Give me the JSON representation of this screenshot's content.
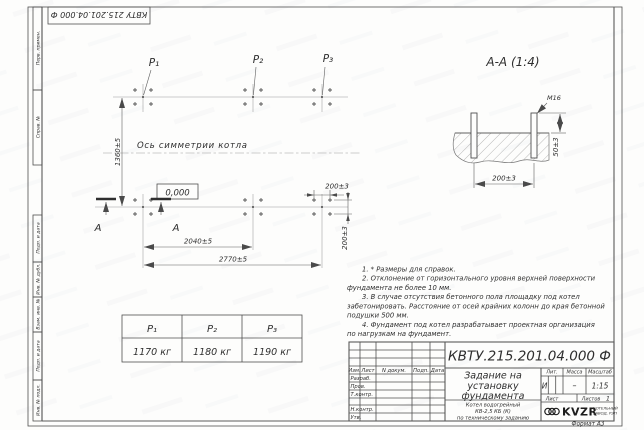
{
  "page": {
    "format_label": "Формат А3"
  },
  "top_stamp": {
    "text": "КВТУ 215.201.04.000  Ф"
  },
  "margin_fields": [
    "Перв. примен.",
    "Справ. №",
    "Подп. и дата",
    "Инв. № дубл.",
    "Взам. инв. №",
    "Подп. и дата",
    "Инв. № подл."
  ],
  "plan": {
    "load_labels": [
      "P₁",
      "P₂",
      "P₃"
    ],
    "axis_label": "Ось симметрии котла",
    "level_mark": "0,000",
    "section_letter": "А",
    "dim_height": "1360±5",
    "dim_width_mid": "2040±5",
    "dim_width_full": "2770±5",
    "dim_bolt_x": "200±3",
    "dim_bolt_y": "200±3"
  },
  "section_view": {
    "title": "А-А (1:4)",
    "thread_label": "М16",
    "dim_protrusion": "50±3",
    "dim_spacing": "200±3"
  },
  "notes": {
    "lines": [
      "1. * Размеры для справок.",
      "2. Отклонение от горизонтального уровня верхней поверхности",
      "фундамента не более 10 мм.",
      "3. В случае отсутствия бетонного пола площадку под котел",
      "забетонировать. Расстояние от осей крайних колонн до края бетонной",
      "подушки 500 мм.",
      "4. Фундамент под котел разрабатывает проектная организация",
      "по нагрузкам на фундамент."
    ]
  },
  "load_table": {
    "headers": [
      "P₁",
      "P₂",
      "P₃"
    ],
    "values": [
      "1170 кг",
      "1180 кг",
      "1190 кг"
    ]
  },
  "title_block": {
    "doc_number": "КВТУ.215.201.04.000  Ф",
    "doc_title_lines": [
      "Задание на",
      "установку",
      "фундамента"
    ],
    "product_lines": [
      "Котел водогрейный",
      "КВ-2,5 КБ (К)",
      "по техническому заданию"
    ],
    "header_cols": [
      "Изм.",
      "Лист",
      "N докум.",
      "Подп.",
      "Дата"
    ],
    "sign_rows": [
      "Разраб.",
      "Пров.",
      "Т.контр.",
      "Н.контр.",
      "Утв."
    ],
    "lit_label": "Лит.",
    "mass_label": "Масса",
    "scale_label": "Масштаб",
    "lit_value": "И",
    "mass_value": "–",
    "scale_value": "1:15",
    "sheet_label": "Лист",
    "sheets_label": "Листов",
    "sheets_value": "1",
    "logo": {
      "name": "KVZR",
      "sub1": "КОТЕЛЬНЫЙ",
      "sub2": "ЗАВОД, РЭП"
    }
  }
}
